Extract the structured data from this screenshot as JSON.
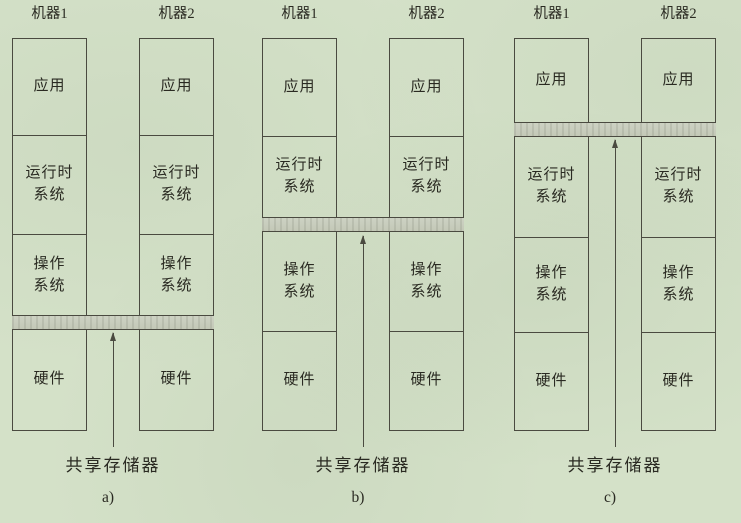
{
  "figure": {
    "description": "三种分布式共享存储器实现层次示意图（两台机器的软硬件层次栈，灰色条带表示共享存储器所在层）",
    "colors": {
      "paper_background": "#d4e1c8",
      "line": "#4a4a40",
      "band_fill": "#c9cebf",
      "text": "#2a2a22"
    },
    "panels": [
      {
        "id": "a",
        "caption": "a)",
        "machines": [
          "机器1",
          "机器2"
        ],
        "layers": [
          "应用",
          "运行时\n系统",
          "操作\n系统",
          "硬件"
        ],
        "shared_memory_label": "共享存储器",
        "shared_band_location": "操作系统与硬件之间"
      },
      {
        "id": "b",
        "caption": "b)",
        "machines": [
          "机器1",
          "机器2"
        ],
        "layers": [
          "应用",
          "运行时\n系统",
          "操作\n系统",
          "硬件"
        ],
        "shared_memory_label": "共享存储器",
        "shared_band_location": "运行时系统与操作系统之间"
      },
      {
        "id": "c",
        "caption": "c)",
        "machines": [
          "机器1",
          "机器2"
        ],
        "layers": [
          "应用",
          "运行时\n系统",
          "操作\n系统",
          "硬件"
        ],
        "shared_memory_label": "共享存储器",
        "shared_band_location": "应用与运行时系统之间"
      }
    ]
  }
}
